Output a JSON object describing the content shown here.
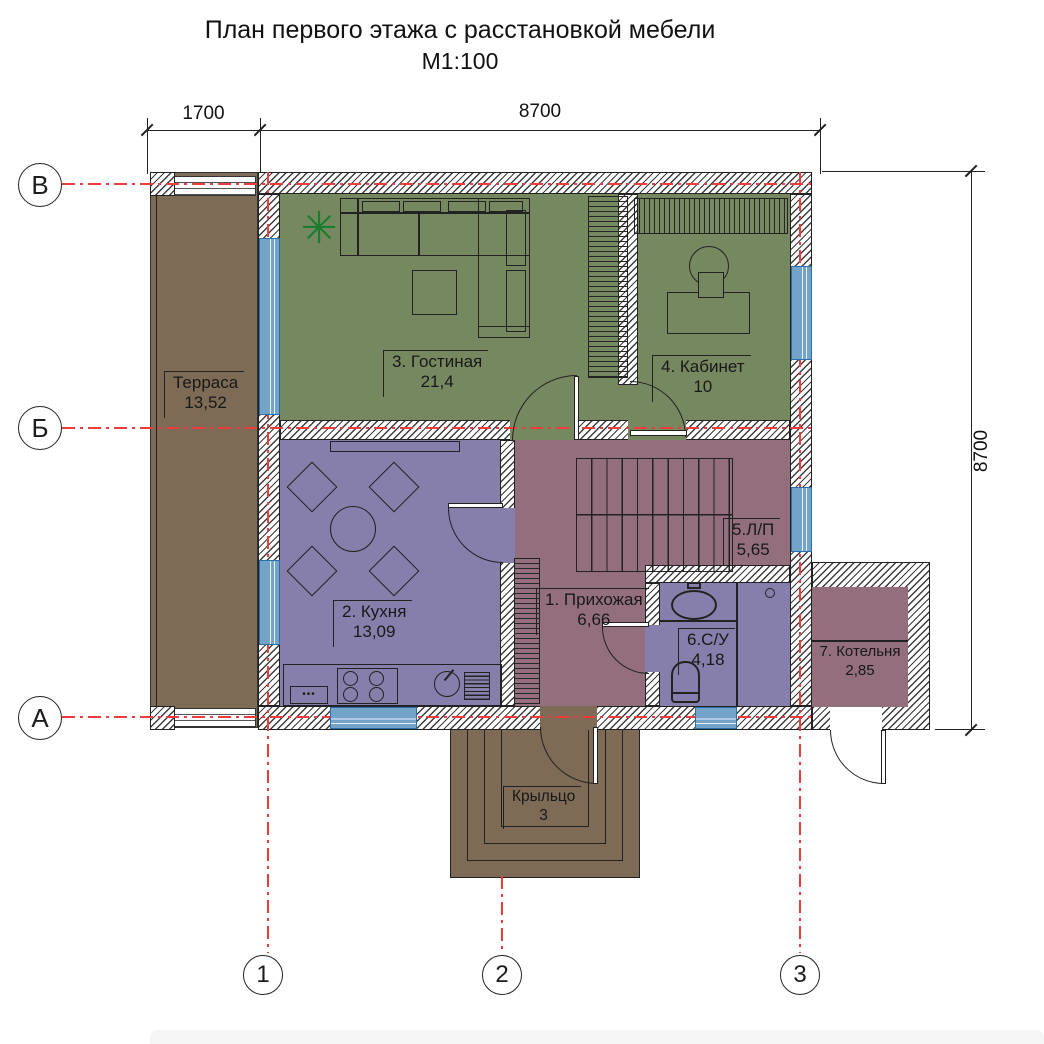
{
  "title": {
    "line1": "План первого этажа  с расстановкой мебели",
    "line2": "М1:100"
  },
  "dimensions": {
    "top_left": "1700",
    "top_right": "8700",
    "right": "8700"
  },
  "axes": {
    "horizontal": [
      "В",
      "Б",
      "А"
    ],
    "vertical": [
      "1",
      "2",
      "3"
    ]
  },
  "rooms": {
    "terrace": {
      "label": "Терраса",
      "area": "13,52"
    },
    "hallway": {
      "label": "1. Прихожая",
      "area": "6,66"
    },
    "kitchen": {
      "label": "2. Кухня",
      "area": "13,09"
    },
    "living": {
      "label": "3. Гостиная",
      "area": "21,4"
    },
    "office": {
      "label": "4. Кабинет",
      "area": "10"
    },
    "stairs": {
      "label": "5.Л/П",
      "area": "5,65"
    },
    "bathroom": {
      "label": "6.С/У",
      "area": "4,18"
    },
    "boiler": {
      "label": "7. Котельня",
      "area": "2,85"
    },
    "porch": {
      "label": "Крыльцо",
      "area": "3"
    }
  },
  "icons": {
    "plant": "✳"
  },
  "furniture": {
    "drawer_dots": "•••"
  },
  "colors": {
    "living_zone_green": "#76885f",
    "kitchen_bath_purple": "#867fab",
    "circulation_maroon": "#936f7e",
    "outdoor_brown": "#7d6b56",
    "window_blue": "#74a3ca",
    "axis_red": "#ee3b3b"
  }
}
